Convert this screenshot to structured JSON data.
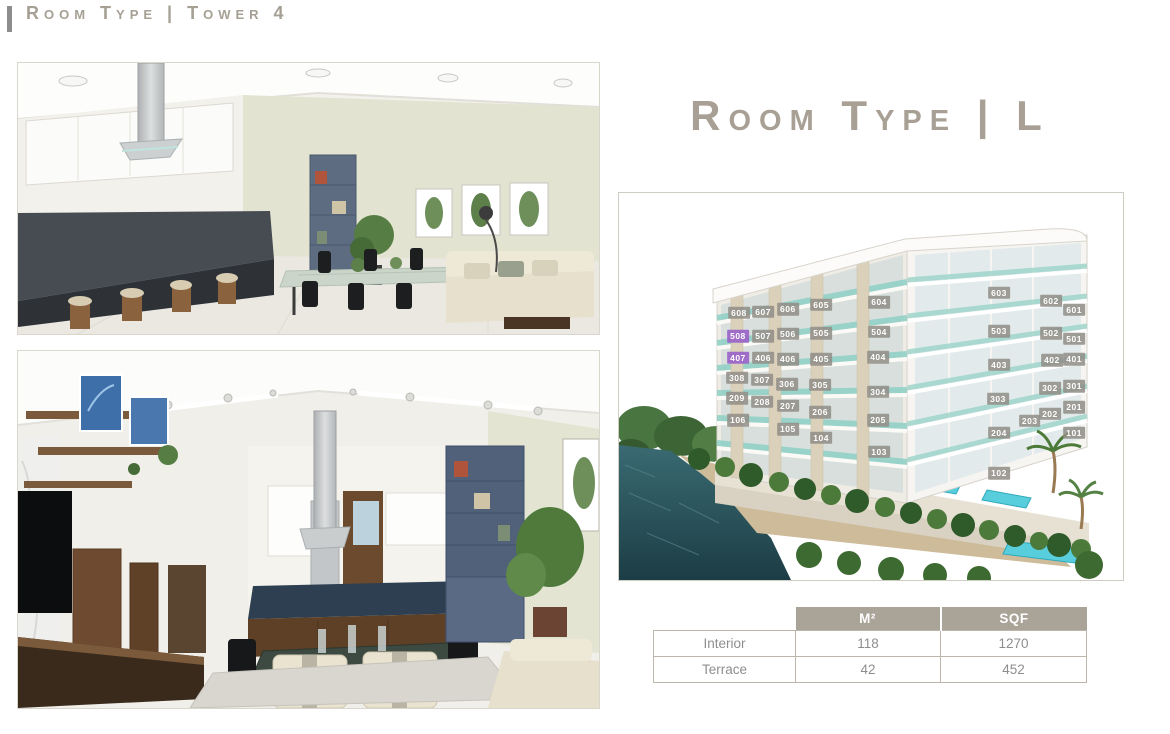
{
  "header": {
    "title": "Room Type | Tower 4"
  },
  "right_panel": {
    "title": "Room Type | L"
  },
  "building": {
    "highlight_color": "#9a64c8",
    "chip_color": "#928f88",
    "units": [
      {
        "label": "608",
        "x": 23.8,
        "y": 31.0,
        "hl": false
      },
      {
        "label": "607",
        "x": 28.6,
        "y": 30.7,
        "hl": false
      },
      {
        "label": "606",
        "x": 33.5,
        "y": 30.0,
        "hl": false
      },
      {
        "label": "605",
        "x": 40.1,
        "y": 28.9,
        "hl": false
      },
      {
        "label": "604",
        "x": 51.6,
        "y": 28.2,
        "hl": false
      },
      {
        "label": "603",
        "x": 75.4,
        "y": 25.8,
        "hl": false
      },
      {
        "label": "602",
        "x": 85.7,
        "y": 27.9,
        "hl": false
      },
      {
        "label": "601",
        "x": 90.3,
        "y": 30.2,
        "hl": false
      },
      {
        "label": "508",
        "x": 23.6,
        "y": 37.0,
        "hl": true
      },
      {
        "label": "507",
        "x": 28.6,
        "y": 37.0,
        "hl": false
      },
      {
        "label": "506",
        "x": 33.5,
        "y": 36.4,
        "hl": false
      },
      {
        "label": "505",
        "x": 40.1,
        "y": 36.2,
        "hl": false
      },
      {
        "label": "504",
        "x": 51.6,
        "y": 35.9,
        "hl": false
      },
      {
        "label": "503",
        "x": 75.4,
        "y": 35.7,
        "hl": false
      },
      {
        "label": "502",
        "x": 85.7,
        "y": 36.2,
        "hl": false
      },
      {
        "label": "501",
        "x": 90.3,
        "y": 37.7,
        "hl": false
      },
      {
        "label": "407",
        "x": 23.6,
        "y": 42.6,
        "hl": true
      },
      {
        "label": "406",
        "x": 28.6,
        "y": 42.6,
        "hl": false
      },
      {
        "label": "406",
        "x": 33.5,
        "y": 42.9,
        "hl": false
      },
      {
        "label": "405",
        "x": 40.1,
        "y": 42.9,
        "hl": false
      },
      {
        "label": "404",
        "x": 51.4,
        "y": 42.4,
        "hl": false
      },
      {
        "label": "403",
        "x": 75.4,
        "y": 44.4,
        "hl": false
      },
      {
        "label": "402",
        "x": 85.9,
        "y": 43.2,
        "hl": false
      },
      {
        "label": "401",
        "x": 90.3,
        "y": 42.9,
        "hl": false
      },
      {
        "label": "308",
        "x": 23.4,
        "y": 47.8,
        "hl": false
      },
      {
        "label": "307",
        "x": 28.4,
        "y": 48.3,
        "hl": false
      },
      {
        "label": "306",
        "x": 33.3,
        "y": 49.4,
        "hl": false
      },
      {
        "label": "305",
        "x": 39.9,
        "y": 49.6,
        "hl": false
      },
      {
        "label": "304",
        "x": 51.4,
        "y": 51.4,
        "hl": false
      },
      {
        "label": "303",
        "x": 75.2,
        "y": 53.2,
        "hl": false
      },
      {
        "label": "302",
        "x": 85.5,
        "y": 50.4,
        "hl": false
      },
      {
        "label": "301",
        "x": 90.3,
        "y": 49.9,
        "hl": false
      },
      {
        "label": "209",
        "x": 23.4,
        "y": 53.0,
        "hl": false
      },
      {
        "label": "208",
        "x": 28.4,
        "y": 54.0,
        "hl": false
      },
      {
        "label": "207",
        "x": 33.5,
        "y": 55.0,
        "hl": false
      },
      {
        "label": "206",
        "x": 39.9,
        "y": 56.6,
        "hl": false
      },
      {
        "label": "205",
        "x": 51.4,
        "y": 58.7,
        "hl": false
      },
      {
        "label": "204",
        "x": 75.4,
        "y": 62.0,
        "hl": false
      },
      {
        "label": "203",
        "x": 81.5,
        "y": 58.9,
        "hl": false
      },
      {
        "label": "202",
        "x": 85.5,
        "y": 57.1,
        "hl": false
      },
      {
        "label": "201",
        "x": 90.3,
        "y": 55.3,
        "hl": false
      },
      {
        "label": "106",
        "x": 23.6,
        "y": 58.7,
        "hl": false
      },
      {
        "label": "105",
        "x": 33.5,
        "y": 61.0,
        "hl": false
      },
      {
        "label": "104",
        "x": 40.1,
        "y": 63.3,
        "hl": false
      },
      {
        "label": "103",
        "x": 51.6,
        "y": 66.9,
        "hl": false
      },
      {
        "label": "102",
        "x": 75.4,
        "y": 72.4,
        "hl": false
      },
      {
        "label": "101",
        "x": 90.3,
        "y": 62.0,
        "hl": false
      }
    ]
  },
  "table": {
    "columns": [
      "",
      "M²",
      "SQF"
    ],
    "rows": [
      {
        "label": "Interior",
        "m2": "118",
        "sqf": "1270"
      },
      {
        "label": "Terrace",
        "m2": "42",
        "sqf": "452"
      }
    ]
  }
}
